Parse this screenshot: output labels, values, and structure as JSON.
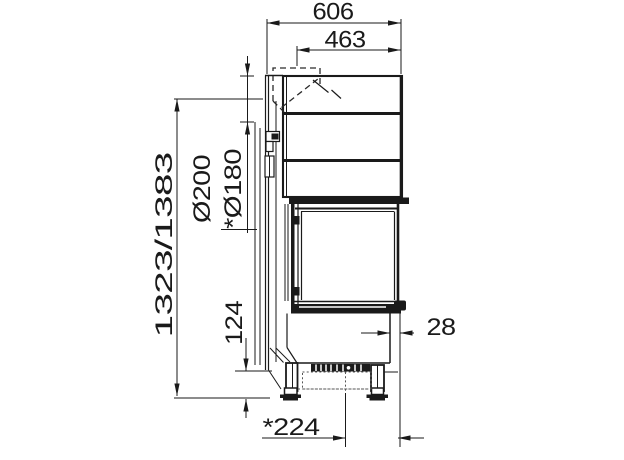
{
  "page": {
    "background": "#ffffff"
  },
  "drawing": {
    "subject": "fireplace-insert-side-elevation",
    "line_color": "#1a1a1a",
    "dimensions": {
      "total_width": "606",
      "upper_width": "463",
      "flue_diameter": "Ø200",
      "flue_diameter_alt": "*Ø180",
      "overall_height": "1323/1383",
      "plinth_height": "124",
      "front_offset": "28",
      "base_depth": "*224"
    }
  }
}
